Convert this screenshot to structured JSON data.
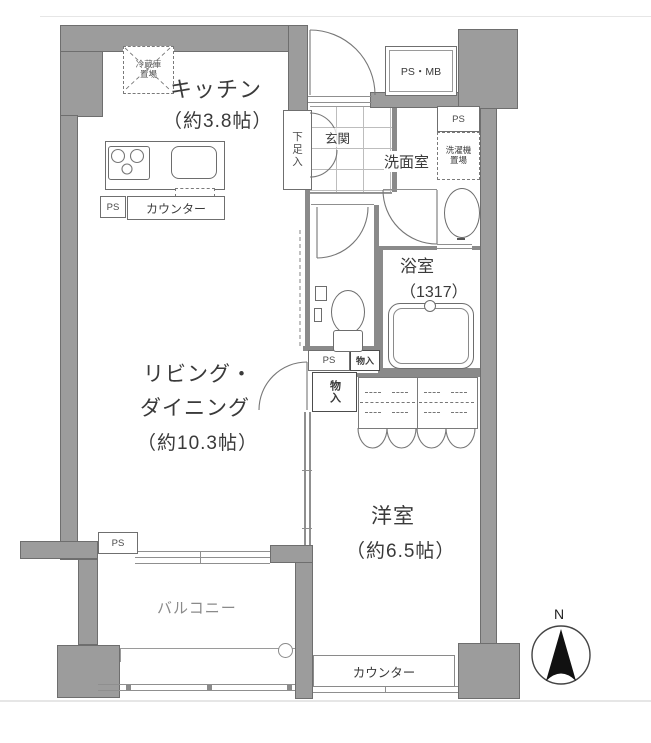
{
  "title": "apartment-floor-plan",
  "rooms": {
    "kitchen": {
      "name": "キッチン",
      "size": "（約3.8帖）"
    },
    "living": {
      "name_line1": "リビング・",
      "name_line2": "ダイニング",
      "size": "（約10.3帖）"
    },
    "western_room": {
      "name": "洋室",
      "size": "（約6.5帖）"
    },
    "bathroom": {
      "name": "浴室",
      "size": "（1317）"
    },
    "washroom": {
      "name": "洗面室"
    },
    "entrance": {
      "name": "玄関"
    },
    "balcony": {
      "name": "バルコニー"
    }
  },
  "labels": {
    "ps": "PS",
    "ps_mb": "PS・MB",
    "refrigerator_line1": "冷蔵庫",
    "refrigerator_line2": "置場",
    "washing_machine_line1": "洗濯機",
    "washing_machine_line2": "置場",
    "shoe_cabinet": "下足入",
    "storage": "物入",
    "counter": "カウンター",
    "north": "N"
  },
  "colors": {
    "wall": "#9c9c9c",
    "outline": "#6e6e6e",
    "text": "#3a3a3a",
    "light_text": "#8a8a8a"
  }
}
